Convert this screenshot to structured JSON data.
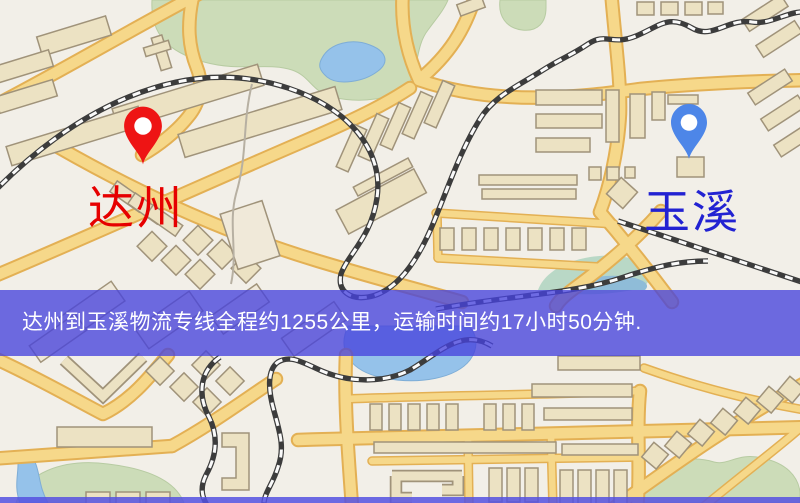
{
  "banner": {
    "text": "达州到玉溪物流专线全程约1255公里，运输时间约17小时50分钟.",
    "bg_color": "rgba(70,66,220,0.78)",
    "text_color": "#ffffff"
  },
  "locations": {
    "origin": {
      "label": "达州",
      "pin_color": "#ee1414",
      "label_color": "#e60000"
    },
    "destination": {
      "label": "玉溪",
      "pin_color": "#4d86e8",
      "label_color": "#2222d2"
    }
  },
  "map_colors": {
    "background": "#f2efe8",
    "road": "#f6d88a",
    "road_casing": "#e3b054",
    "building": "#ece2c3",
    "park": "#ccdcb8",
    "water": "#95c2ea",
    "railway": "#3c3c3c"
  }
}
